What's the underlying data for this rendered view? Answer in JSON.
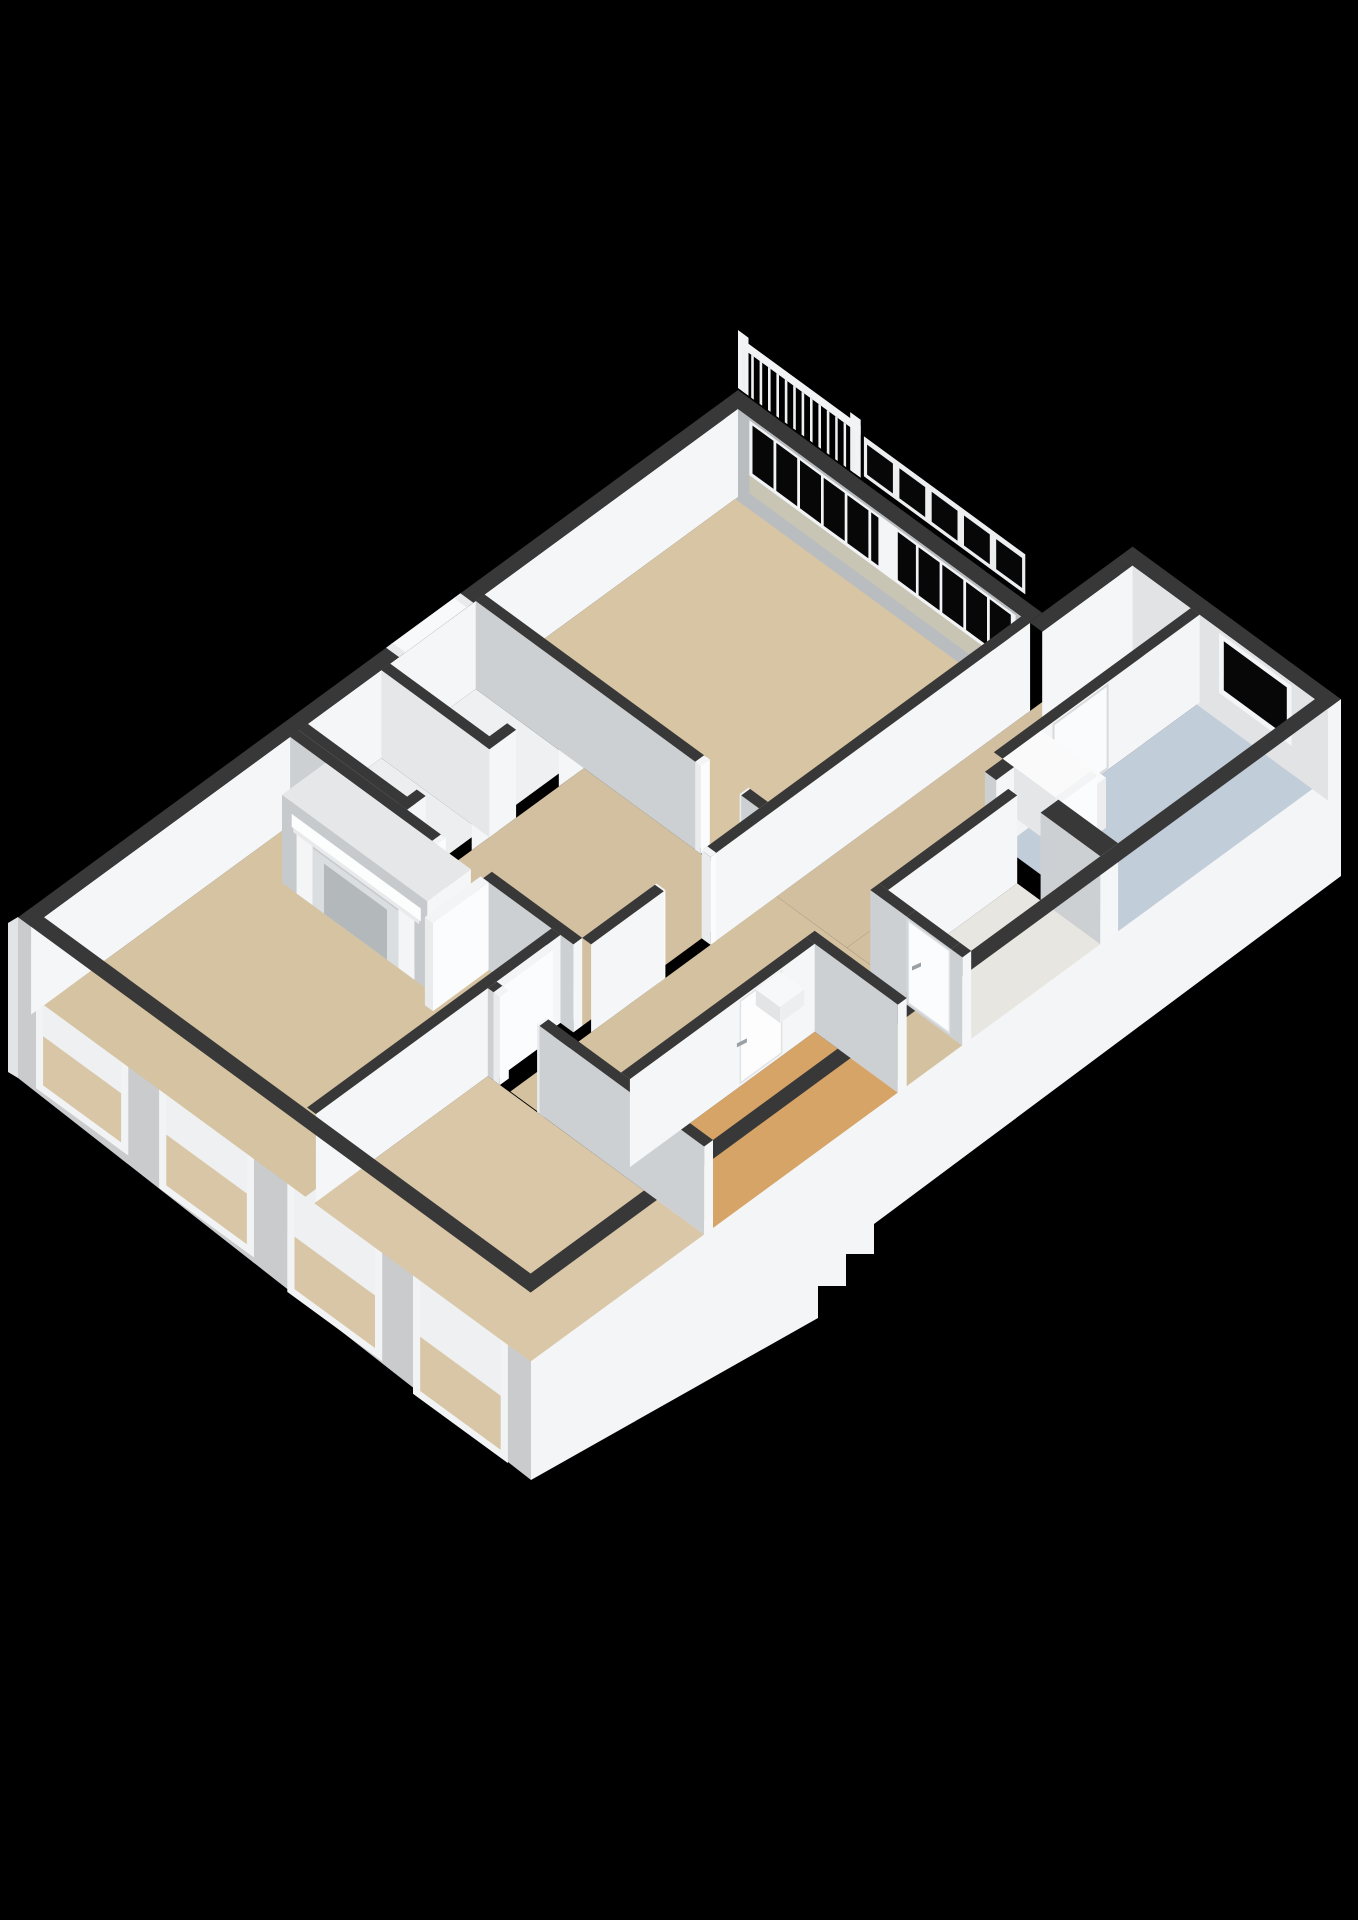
{
  "scene": {
    "type": "3d-floor-plan-render",
    "background": "#000000",
    "canvas": {
      "width": 1358,
      "height": 1920
    },
    "projection": {
      "ox": 738,
      "oy": 390,
      "ax": 0.807,
      "ay": 0.591,
      "wall_height": 88
    },
    "palette": {
      "wallTop": "#383838",
      "wallTopLight": "#3f3f3f",
      "faceX": "#f5f6f7",
      "faceY": "#ccd0d3",
      "white": "#fbfcfd",
      "bandBase": "#b9bdc0",
      "bandSill": "#c9c5b4",
      "glass": "#070708",
      "skirtSW": "#c9cbcd",
      "skirtSE": "#f4f5f6",
      "skirtNW": "#e3e4e5",
      "beige": "#d6c3a2",
      "orange": "#d7a468",
      "blue": "#c2cdda",
      "handle": "#9aa0a4"
    },
    "facades": {
      "sw": {
        "points": [
          [
            18,
            917
          ],
          [
            531,
            1292
          ],
          [
            531,
            1480
          ],
          [
            18,
            1078
          ]
        ],
        "fill": "#c9cbcd",
        "windows": [
          {
            "f1": 0.035,
            "f2": 0.215,
            "v1": 36,
            "v2": 158
          },
          {
            "f1": 0.275,
            "f2": 0.46,
            "v1": 42,
            "v2": 168
          },
          {
            "f1": 0.525,
            "f2": 0.71,
            "v1": 48,
            "v2": 178
          },
          {
            "f1": 0.77,
            "f2": 0.955,
            "v1": 54,
            "v2": 188
          }
        ],
        "window_frame": "#f2f3f4",
        "window_wall": "#eef0f1",
        "window_floor": "#d8c6a6"
      },
      "se": {
        "points": [
          [
            531,
            1292
          ],
          [
            1341,
            699
          ],
          [
            1341,
            876
          ],
          [
            874,
            1224
          ],
          [
            874,
            1254
          ],
          [
            846,
            1254
          ],
          [
            846,
            1286
          ],
          [
            818,
            1286
          ],
          [
            818,
            1318
          ],
          [
            531,
            1480
          ]
        ],
        "fill": "#f4f5f6"
      },
      "nw": {
        "points": [
          [
            18,
            917
          ],
          [
            8,
            923
          ],
          [
            8,
            1072
          ],
          [
            18,
            1078
          ]
        ],
        "fill": "#e3e4e5"
      }
    },
    "railing": {
      "x1": 2,
      "x2": 152,
      "rail_v1": -54,
      "rail_v2": -45,
      "balusters": 14,
      "bal_start": 6,
      "bal_step": 10.4,
      "bal_w": 3.2,
      "posts": [
        [
          0,
          13
        ],
        [
          139,
          152
        ]
      ],
      "post_v": -60,
      "fill": "#f2f3f4"
    },
    "upper_sashes": {
      "strip": [
        156,
        356,
        -46,
        -6
      ],
      "panes": 5,
      "start": 160,
      "step": 40,
      "w": 32,
      "v1": -40,
      "v2": -10,
      "frame": "#eceeef"
    },
    "band_ne": {
      "wall": [
        0,
        0,
        377,
        16
      ],
      "h": 92,
      "x1": 30,
      "x2": 360,
      "underlay_v": [
        3,
        58
      ],
      "panes": 11,
      "pane_start": 34,
      "pane_w": 26,
      "pane_step": 29.4,
      "glass_v": [
        6,
        54
      ],
      "mullion": [
        190,
        214
      ],
      "sill_v": [
        58,
        76
      ]
    },
    "band_wing": {
      "wall": [
        377,
        -112,
        635,
        -96
      ],
      "h": 92,
      "base": "#e1e3e5",
      "frame": [
        500,
        590,
        4,
        64
      ],
      "glass": [
        506,
        584,
        9,
        58
      ]
    },
    "floors": [
      {
        "name": "floor-living-room",
        "r": [
          16,
          16,
          367,
          330
        ],
        "fill": "#d8c5a4"
      },
      {
        "name": "floor-vestibule",
        "r": [
          150,
          341,
          367,
          560
        ],
        "fill": "#d3c0a0"
      },
      {
        "name": "floor-closet-1",
        "r": [
          16,
          341,
          139,
          447
        ],
        "fill": "#eef0f1"
      },
      {
        "name": "floor-closet-2",
        "r": [
          16,
          458,
          139,
          549
        ],
        "fill": "#eceef0"
      },
      {
        "name": "floor-fireplace-room",
        "r": [
          16,
          571,
          340,
          876
        ],
        "fill": "#d6c3a2"
      },
      {
        "name": "floor-bottom-room",
        "r": [
          351,
          661,
          619,
          876
        ],
        "fill": "#d9c7a7"
      },
      {
        "name": "floor-entry-hall",
        "r": [
          378,
          -96,
          465,
          330
        ],
        "fill": "#d2bfa0"
      },
      {
        "name": "floor-hall",
        "r": [
          378,
          330,
          505,
          660
        ],
        "fill": "#d4c1a0"
      },
      {
        "name": "floor-hall-east",
        "r": [
          505,
          341,
          619,
          410
        ],
        "fill": "#d4c1a0"
      },
      {
        "name": "floor-hall-sliver",
        "r": [
          465,
          159,
          505,
          330
        ],
        "fill": "#d2bfa0"
      },
      {
        "name": "floor-kitchen",
        "r": [
          476,
          -96,
          619,
          148
        ],
        "fill": "#c2cdda"
      },
      {
        "name": "floor-wc",
        "r": [
          516,
          170,
          619,
          330
        ],
        "fill": "#e8e6e1"
      },
      {
        "name": "floor-orange-room",
        "r": [
          516,
          421,
          619,
          650
        ],
        "fill": "#d7a468"
      }
    ],
    "walls": [
      {
        "name": "wall-ne-main-window-band",
        "r": [
          0,
          0,
          377,
          16
        ],
        "v": "bandNE"
      },
      {
        "name": "wall-ne-wing-window",
        "r": [
          377,
          -112,
          635,
          -96
        ],
        "v": "bandWing"
      },
      {
        "name": "wall-wing-nw",
        "r": [
          377,
          -96,
          393,
          16
        ],
        "fy": false
      },
      {
        "name": "wall-nw-exterior",
        "r": [
          0,
          16,
          16,
          892
        ],
        "fy": false
      },
      {
        "name": "wall-closet-stub-1",
        "r": [
          139,
          341,
          150,
          372
        ],
        "fy": false
      },
      {
        "name": "wall-closet-stub-2",
        "r": [
          139,
          425,
          150,
          480
        ],
        "fy": false
      },
      {
        "name": "wall-closet-stub-3",
        "r": [
          139,
          537,
          150,
          560
        ],
        "fy": false
      },
      {
        "name": "wall-closet-divider",
        "r": [
          16,
          447,
          150,
          458
        ],
        "fyc": "#e5e7e9"
      },
      {
        "name": "wall-closet-south",
        "r": [
          16,
          549,
          150,
          560
        ],
        "fy": false,
        "fx": false
      },
      {
        "name": "wall-living-sw-a",
        "r": [
          16,
          330,
          290,
          341
        ]
      },
      {
        "name": "post-living-door-1",
        "r": [
          288,
          330,
          295,
          341
        ],
        "white": true
      },
      {
        "name": "post-living-door-2",
        "r": [
          343,
          330,
          350,
          341
        ],
        "white": true
      },
      {
        "name": "wall-living-sw-b",
        "r": [
          345,
          330,
          367,
          341
        ]
      },
      {
        "name": "wall-living-se-a",
        "r": [
          367,
          16,
          378,
          410
        ],
        "fy": false
      },
      {
        "name": "post-hall-door-1",
        "r": [
          367,
          405,
          378,
          412
        ],
        "white": true
      },
      {
        "name": "post-hall-door-2",
        "r": [
          367,
          468,
          378,
          475
        ],
        "white": true
      },
      {
        "name": "wall-living-se-b",
        "r": [
          367,
          470,
          378,
          560
        ],
        "fy": false
      },
      {
        "name": "wall-arch",
        "r": [
          465,
          -96,
          476,
          148
        ],
        "v": "arch"
      },
      {
        "name": "kitchen-counter",
        "r": [
          476,
          100,
          556,
          148
        ],
        "h": 50,
        "fxc": "#ededef",
        "fyc": "#e4e6e8",
        "top": "#fafafa"
      },
      {
        "name": "wall-kitchen-sw-a",
        "r": [
          476,
          148,
          490,
          170
        ]
      },
      {
        "name": "door-kitchen-open-leaf",
        "r": [
          541,
          104,
          549,
          148
        ],
        "white": true
      },
      {
        "name": "wall-kitchen-sw-b",
        "r": [
          545,
          148,
          619,
          170
        ]
      },
      {
        "name": "wall-se-exterior",
        "r": [
          619,
          -112,
          635,
          892
        ],
        "fx": false,
        "fy": false
      },
      {
        "name": "wall-vestibule-s-a",
        "r": [
          16,
          560,
          195,
          571
        ]
      },
      {
        "name": "post-fire-door-1",
        "r": [
          192,
          560,
          198,
          571
        ],
        "white": true
      },
      {
        "name": "post-fire-door-2",
        "r": [
          255,
          560,
          261,
          571
        ],
        "white": true
      },
      {
        "name": "wall-vestibule-s-b",
        "r": [
          255,
          560,
          367,
          571
        ]
      },
      {
        "name": "chimney-breast",
        "r": [
          60,
          571,
          240,
          625
        ],
        "v": "mantel"
      },
      {
        "name": "door-fireplace-open-leaf",
        "r": [
          252,
          571,
          262,
          640
        ],
        "white": true
      },
      {
        "name": "wall-wc-nw",
        "r": [
          505,
          170,
          516,
          330
        ],
        "fy": false
      },
      {
        "name": "wall-wc-sw-a",
        "r": [
          505,
          330,
          550,
          341
        ]
      },
      {
        "name": "wall-wc-door",
        "r": [
          550,
          330,
          605,
          341
        ],
        "v": "doorY",
        "handle_u": 0.12,
        "handle_v": 46
      },
      {
        "name": "wall-wc-sw-b",
        "r": [
          605,
          330,
          619,
          341
        ]
      },
      {
        "name": "wall-fireplace-se",
        "r": [
          340,
          571,
          351,
          874
        ],
        "fy": false
      },
      {
        "name": "door-bottom-room-open-leaf",
        "r": [
          351,
          588,
          359,
          652
        ],
        "white": true
      },
      {
        "name": "wall-bottom-n-stub",
        "r": [
          351,
          650,
          360,
          661
        ]
      },
      {
        "name": "post-bottom-door-1",
        "r": [
          358,
          650,
          366,
          661
        ],
        "white": true
      },
      {
        "name": "post-bottom-door-2",
        "r": [
          412,
          650,
          420,
          661
        ],
        "white": true
      },
      {
        "name": "wall-bottom-n",
        "r": [
          415,
          650,
          619,
          661
        ]
      },
      {
        "name": "wall-orange-n",
        "r": [
          505,
          410,
          619,
          421
        ]
      },
      {
        "name": "wall-orange-nw",
        "r": [
          505,
          421,
          516,
          650
        ],
        "v": "doorX",
        "door_y1": 462,
        "door_y2": 513,
        "handle_y": 505,
        "handle_v": 45
      },
      {
        "name": "orange-room-doorstep",
        "r": [
          518,
          466,
          548,
          496
        ],
        "h": 16,
        "fxc": "#eceef0",
        "fyc": "#e2e4e6",
        "top": "#f7f8f9"
      },
      {
        "name": "wall-sw-exterior",
        "r": [
          0,
          876,
          635,
          892
        ],
        "fx": false,
        "fy": false
      }
    ],
    "overlays": [
      {
        "type": "flat",
        "name": "nw-door-gap",
        "r": [
          0,
          350,
          16,
          430
        ],
        "fill": "#f8f9fa"
      },
      {
        "type": "flat",
        "name": "nw-door-post-1",
        "r": [
          0,
          344,
          16,
          352
        ],
        "fill": "#e8eaeb"
      },
      {
        "type": "flat",
        "name": "nw-door-post-2",
        "r": [
          0,
          428,
          16,
          436
        ],
        "fill": "#e8eaeb"
      }
    ],
    "arch_detail": {
      "x": 476,
      "fill_opening": "#d8cbb0",
      "step_fill": "#f2f3f4",
      "door": {
        "y1": 18,
        "y2": 85,
        "v1": 3,
        "v2": 86,
        "fill": "#fafbfc",
        "stroke": "#d9dadb",
        "handle_y": 78,
        "handle_v": 46
      },
      "opening_pts": [
        [
          95,
          88
        ],
        [
          95,
          44
        ],
        [
          96,
          33
        ],
        [
          100,
          24
        ],
        [
          106,
          18
        ],
        [
          113,
          15
        ],
        [
          120,
          14
        ],
        [
          127,
          15
        ],
        [
          134,
          18
        ],
        [
          140,
          24
        ],
        [
          144,
          33
        ],
        [
          145,
          44
        ],
        [
          145,
          88
        ]
      ],
      "step": {
        "y1": 102,
        "y2": 138,
        "v1": 66,
        "v2": 88
      }
    },
    "mantel_detail": {
      "base": "#c7cacd",
      "top": "#e6e7e8",
      "shelf": [
        72,
        232,
        12,
        25
      ],
      "under": [
        74,
        230,
        25,
        29
      ],
      "pilaster_l": [
        78,
        98,
        29,
        88
      ],
      "pilaster_r": [
        204,
        224,
        29,
        88
      ],
      "panel": [
        98,
        204,
        31,
        88
      ],
      "firebox": [
        112,
        190,
        38,
        88
      ],
      "shelf_fill": "#fcfdfd",
      "pilaster_fill": "#f4f5f6",
      "panel_fill": "#dbdee0",
      "firebox_fill": "#b3b8bb"
    }
  }
}
